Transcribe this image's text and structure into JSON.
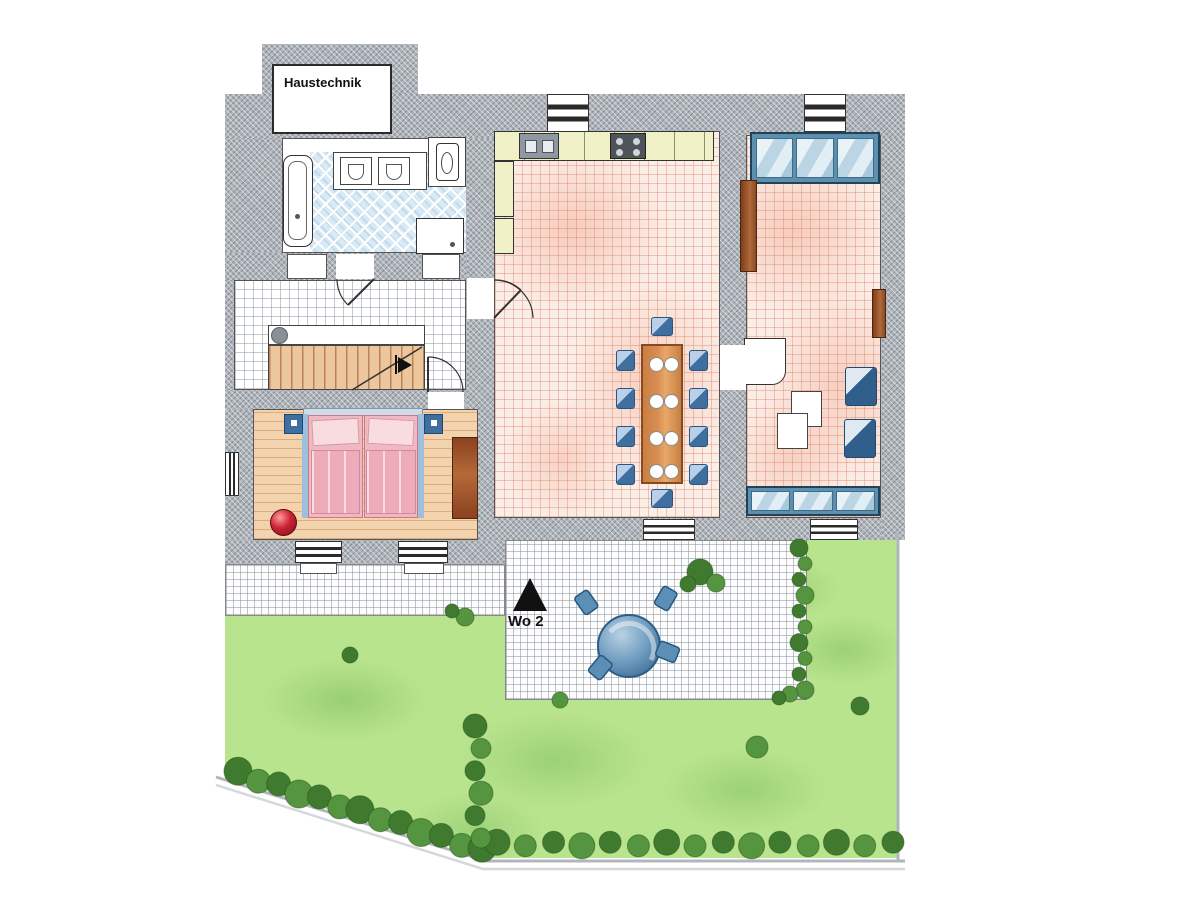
{
  "labels": {
    "haustechnik": "Haustechnik",
    "marker": "Wo 2"
  },
  "colors": {
    "wall": "#aeb4ba",
    "floorPink": "#fbeee7",
    "tileBath": "#d9eaf5",
    "wood": "#f3d3ae",
    "counter": "#f0f1c6",
    "sofa": "#5e8fae",
    "chairBlue": "#4f81b2",
    "tableWood": "#d98f54",
    "tableEdge": "#8a4a1f",
    "bedPink": "#f2b8c2",
    "pillowPink": "#f8dce0",
    "wardrobeBrown": "#9a4f22",
    "ballRed": "#cc2233",
    "grass": "#b9e48e",
    "grassDark": "#7fbf5f",
    "hedge": "#55953f",
    "hedgeDark": "#3f7a2e",
    "sidewalk": "#b0b6ba",
    "markerBlack": "#111111",
    "stairWood": "#ecc79e",
    "terraceTable": "#4a7aa0"
  }
}
